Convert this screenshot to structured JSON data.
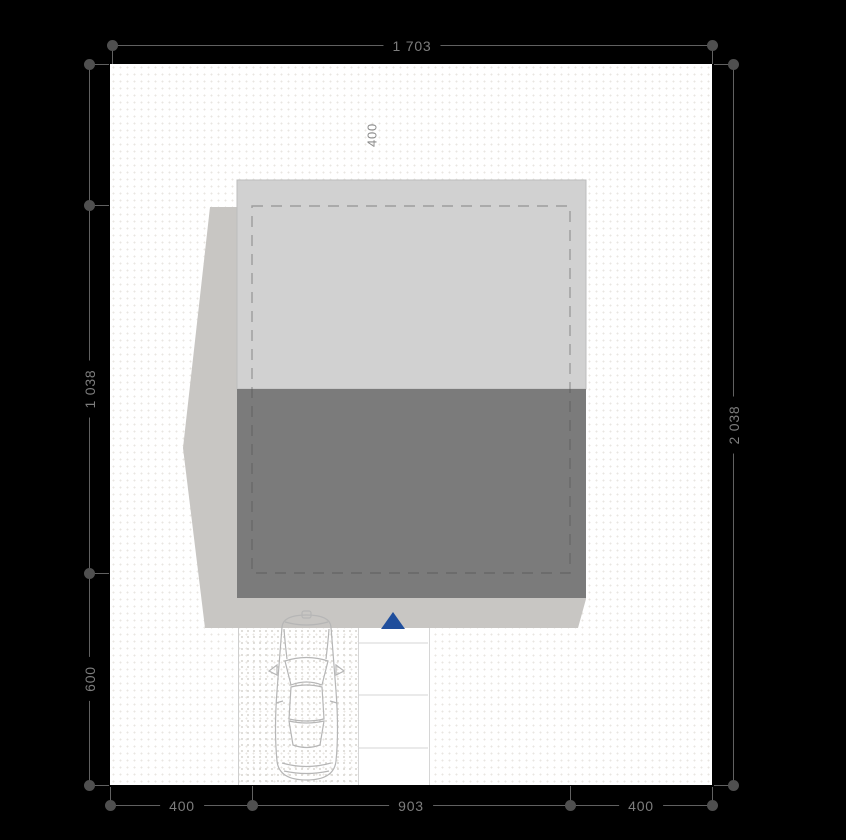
{
  "drawing": {
    "kind": "site-plan",
    "dimension_labels": {
      "plot_width_top": "1 703",
      "plot_height_right": "2 038",
      "building_depth_left": "1 038",
      "driveway_depth_left": "600",
      "front_setback_inner": "400",
      "bottom_left_setback": "400",
      "building_width_bottom": "903",
      "bottom_right_setback": "400"
    },
    "colors": {
      "background": "#000000",
      "plot_fill": "#ffffff",
      "roof": "#d1d1d1",
      "roof_edge": "#bdbdbd",
      "walls": "#7b7b7b",
      "shadow": "#c8c6c3",
      "dashed_outline": "#4a4a4a",
      "accent_blue": "#1f4e9c",
      "car_outline": "#b6b6b6",
      "walkway_line": "#d6d6d6",
      "dimension_gray": "#7d7d7d"
    },
    "icons": {
      "entrance_marker": "triangle-up",
      "vehicle": "car-top-view"
    }
  }
}
